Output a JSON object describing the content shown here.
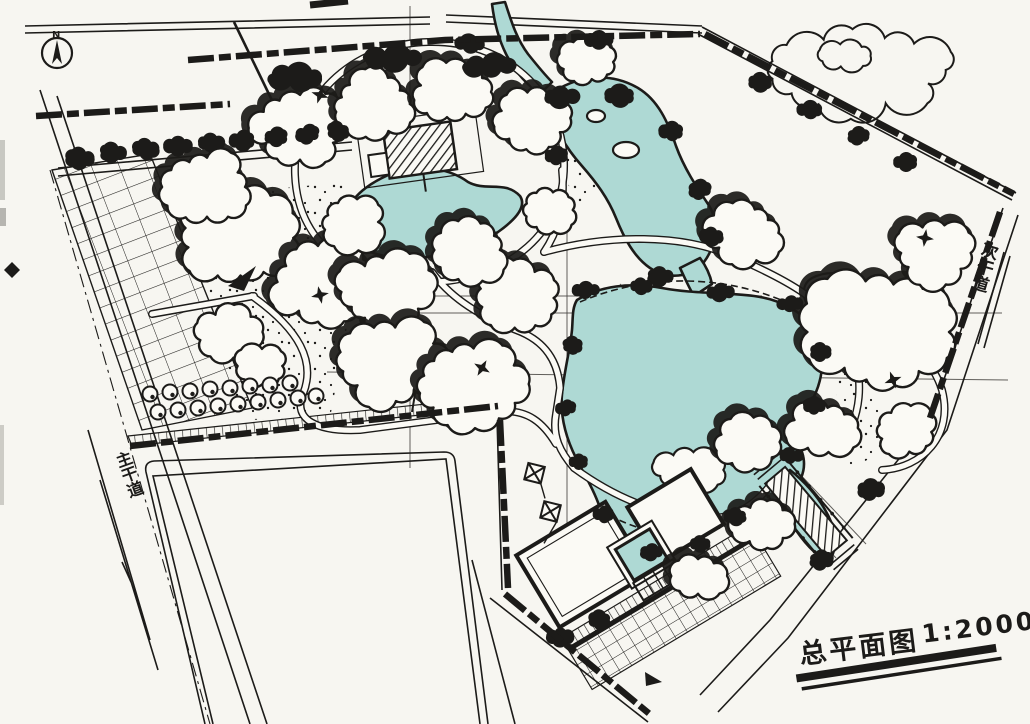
{
  "drawing": {
    "title": "总平面图",
    "scale": "1:2000",
    "north_label": "N",
    "road_label_east": "次干道",
    "road_label_west": "主干道"
  },
  "icons": {
    "north_arrow": "compass-needle-in-circle",
    "tree_symbol": "four-point-star",
    "entrance_marker": "solid-arrow"
  },
  "colors": {
    "ink": "#1c1b19",
    "water": "#aed9d4",
    "paper": "#f7f6f1"
  }
}
